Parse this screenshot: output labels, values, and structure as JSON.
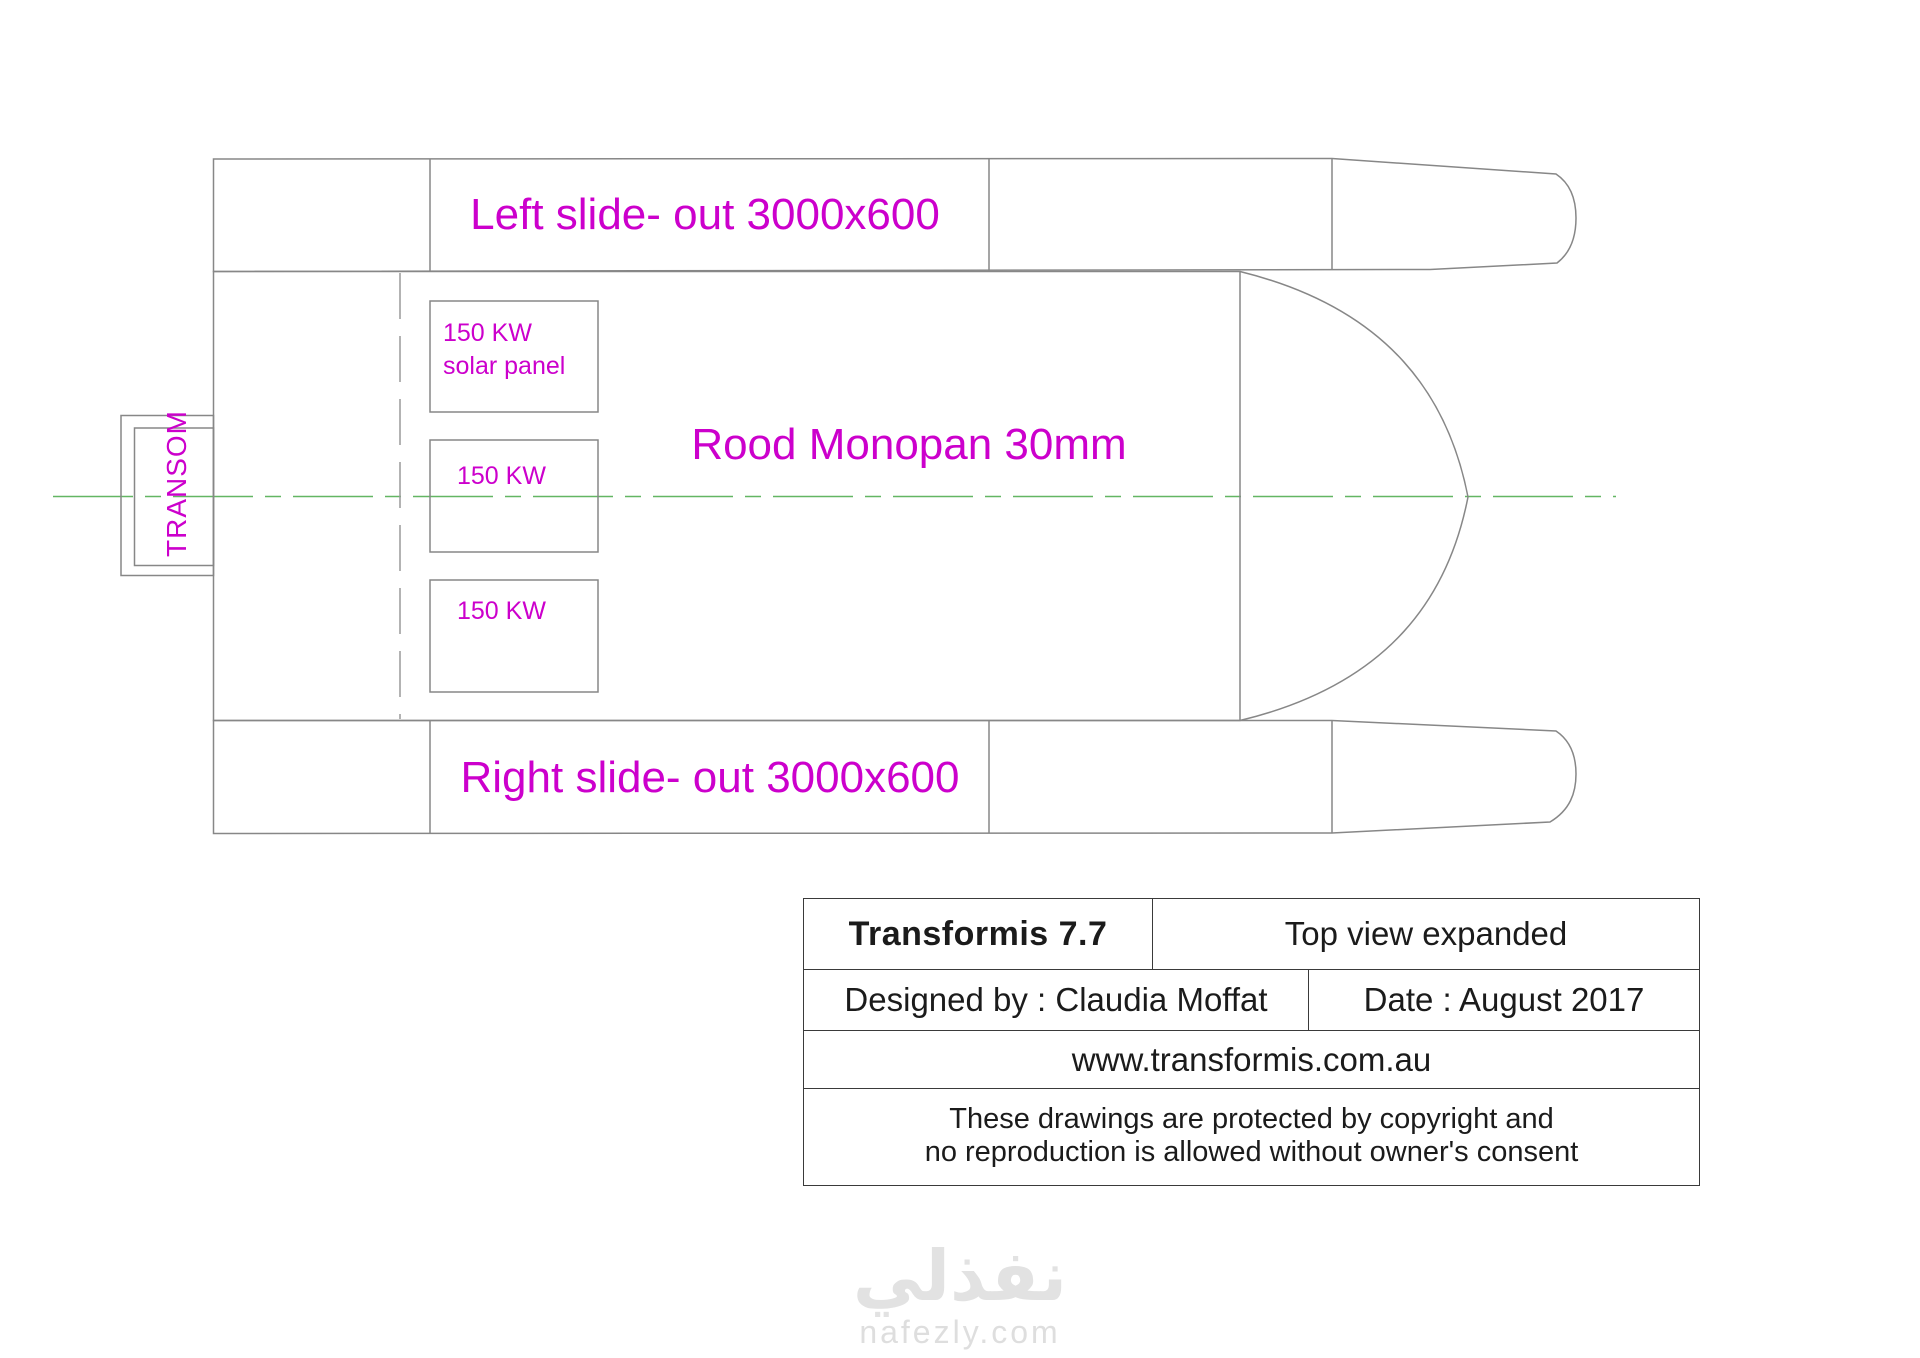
{
  "drawing": {
    "colors": {
      "label_magenta": "#cc00cc",
      "centerline_green": "#63b663",
      "line_gray": "#878787"
    },
    "top_hull": {
      "label": "Left slide- out 3000x600"
    },
    "bottom_hull": {
      "label": "Right slide- out 3000x600"
    },
    "deck": {
      "label": "Rood Monopan 30mm"
    },
    "transom": {
      "label": "TRANSOM"
    },
    "solar_panels": [
      {
        "line1": "150 KW",
        "line2": "solar panel"
      },
      {
        "line1": "150 KW"
      },
      {
        "line1": "150 KW"
      }
    ]
  },
  "title_block": {
    "model_name": "Transformis 7.7",
    "view_name": "Top view expanded",
    "designed_by": "Designed by : Claudia Moffat",
    "date": "Date : August 2017",
    "website": "www.transformis.com.au",
    "copyright_line1": "These drawings are protected by copyright and",
    "copyright_line2": "no reproduction is allowed without owner's consent"
  },
  "watermark": {
    "logo_text": "نفذلي",
    "site_text": "nafezly.com"
  }
}
